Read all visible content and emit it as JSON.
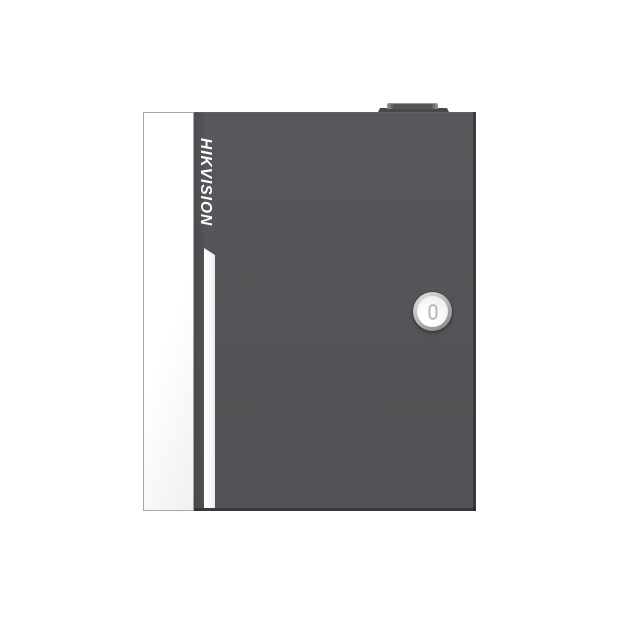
{
  "image_type": "product-photo",
  "product": {
    "brand_label": "HIKVISION"
  },
  "elements": {
    "enclosure": "wall-mount-enclosure-box",
    "side_panel": "white-door-edge-panel",
    "accent_stripe": "white-accent-stripe",
    "lock": "round-cam-lock",
    "keyhole": "keyhole-icon",
    "top_latch": "top-latch-knob"
  },
  "colors": {
    "background": "#ffffff",
    "door_gray": "#57585b",
    "door_gray_dark": "#3f4043",
    "panel_white": "#ffffff",
    "panel_border": "#a6a6a8",
    "lock_rim": "#8d8e90",
    "brand_text": "#ffffff"
  }
}
